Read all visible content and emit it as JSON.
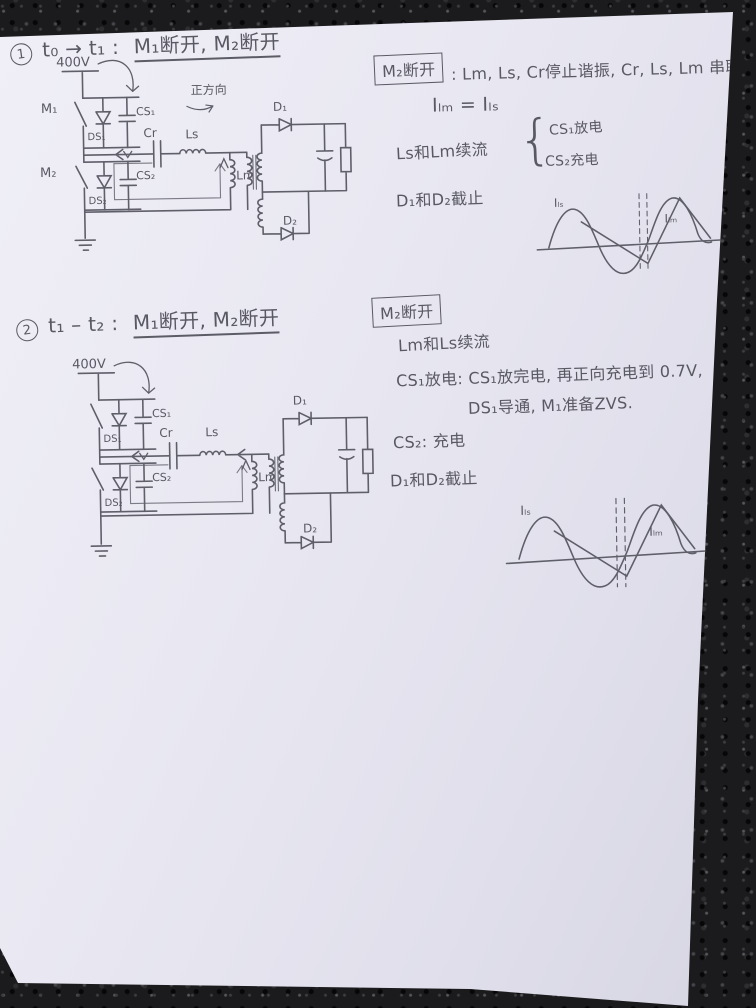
{
  "colors": {
    "ink": "#595963",
    "paper": "#e8e7f1",
    "asphalt": "#1b1b1d"
  },
  "s1": {
    "marker": "1",
    "title_pre": "t₀ → t₁ :",
    "title_switches": "M₁断开, M₂断开",
    "box": "M₂断开",
    "line1": ": Lm, Ls, Cr停止谐振, Cr, Ls, Lm 串联;",
    "line2": "Iₗₘ = Iₗₛ",
    "line3": "Ls和Lm续流",
    "brace": "{",
    "brace_item1": "CS₁放电",
    "brace_item2": "CS₂充电",
    "line4": "D₁和D₂截止",
    "circuit": {
      "supply": "400V",
      "m1": "M₁",
      "m2": "M₂",
      "ds1": "DS₁",
      "cs1": "CS₁",
      "ds2": "DS₂",
      "cs2": "CS₂",
      "cr": "Cr",
      "ls": "Ls",
      "lm": "Lm",
      "d1": "D₁",
      "d2": "D₂",
      "direction": "正方向"
    },
    "wave": {
      "sine": "Iₗₛ",
      "tri": "Iₗₘ"
    }
  },
  "s2": {
    "marker": "2",
    "title_pre": "t₁ – t₂ :",
    "title_switches": "M₁断开, M₂断开",
    "box": "M₂断开",
    "line1": "Lm和Ls续流",
    "line2": "CS₁放电: CS₁放完电, 再正向充电到 0.7V,",
    "line3": "DS₁导通, M₁准备ZVS.",
    "line4": "CS₂: 充电",
    "line5": "D₁和D₂截止",
    "circuit": {
      "supply": "400V",
      "ds1": "DS₁",
      "cs1": "CS₁",
      "ds2": "DS₂",
      "cs2": "CS₂",
      "cr": "Cr",
      "ls": "Ls",
      "lm": "Lm",
      "d1": "D₁",
      "d2": "D₂"
    },
    "wave": {
      "sine": "Iₗₛ",
      "tri": "Iₗₘ"
    }
  }
}
